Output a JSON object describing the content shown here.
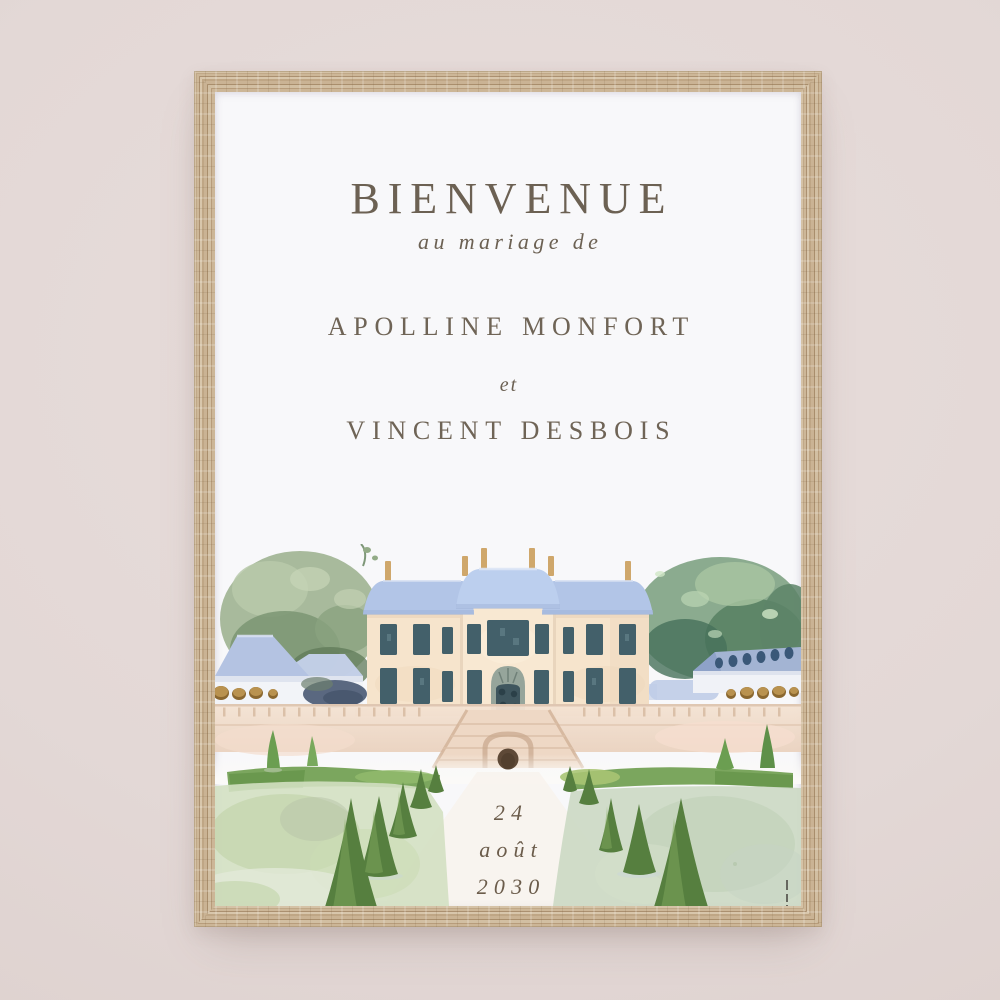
{
  "wall": {
    "color": "#e3d8d6"
  },
  "frame": {
    "material": "light oak wood",
    "color": "#c4ae90"
  },
  "poster": {
    "title": "BIENVENUE",
    "subtitle": "au mariage de",
    "couple": {
      "name_1": "APOLLINE MONFORT",
      "conjunction": "et",
      "name_2": "VINCENT DESBOIS"
    },
    "date": {
      "day": "24",
      "month": "août",
      "year": "2030"
    },
    "text_color": "#6c6153",
    "illustration": {
      "subject": "watercolor château with blue mansard roofs, side pavilions, flanking trees, terrace staircase and formal topiary gardens",
      "palette": {
        "roof_blue": "#b4c7e7",
        "wall_cream": "#f6e3cc",
        "window_slate": "#43606a",
        "foliage_green": "#74a155",
        "lawn_sage": "#cfdcc3",
        "terrace_beige": "#efdccb",
        "stone_tan": "#b08a4c"
      }
    }
  }
}
